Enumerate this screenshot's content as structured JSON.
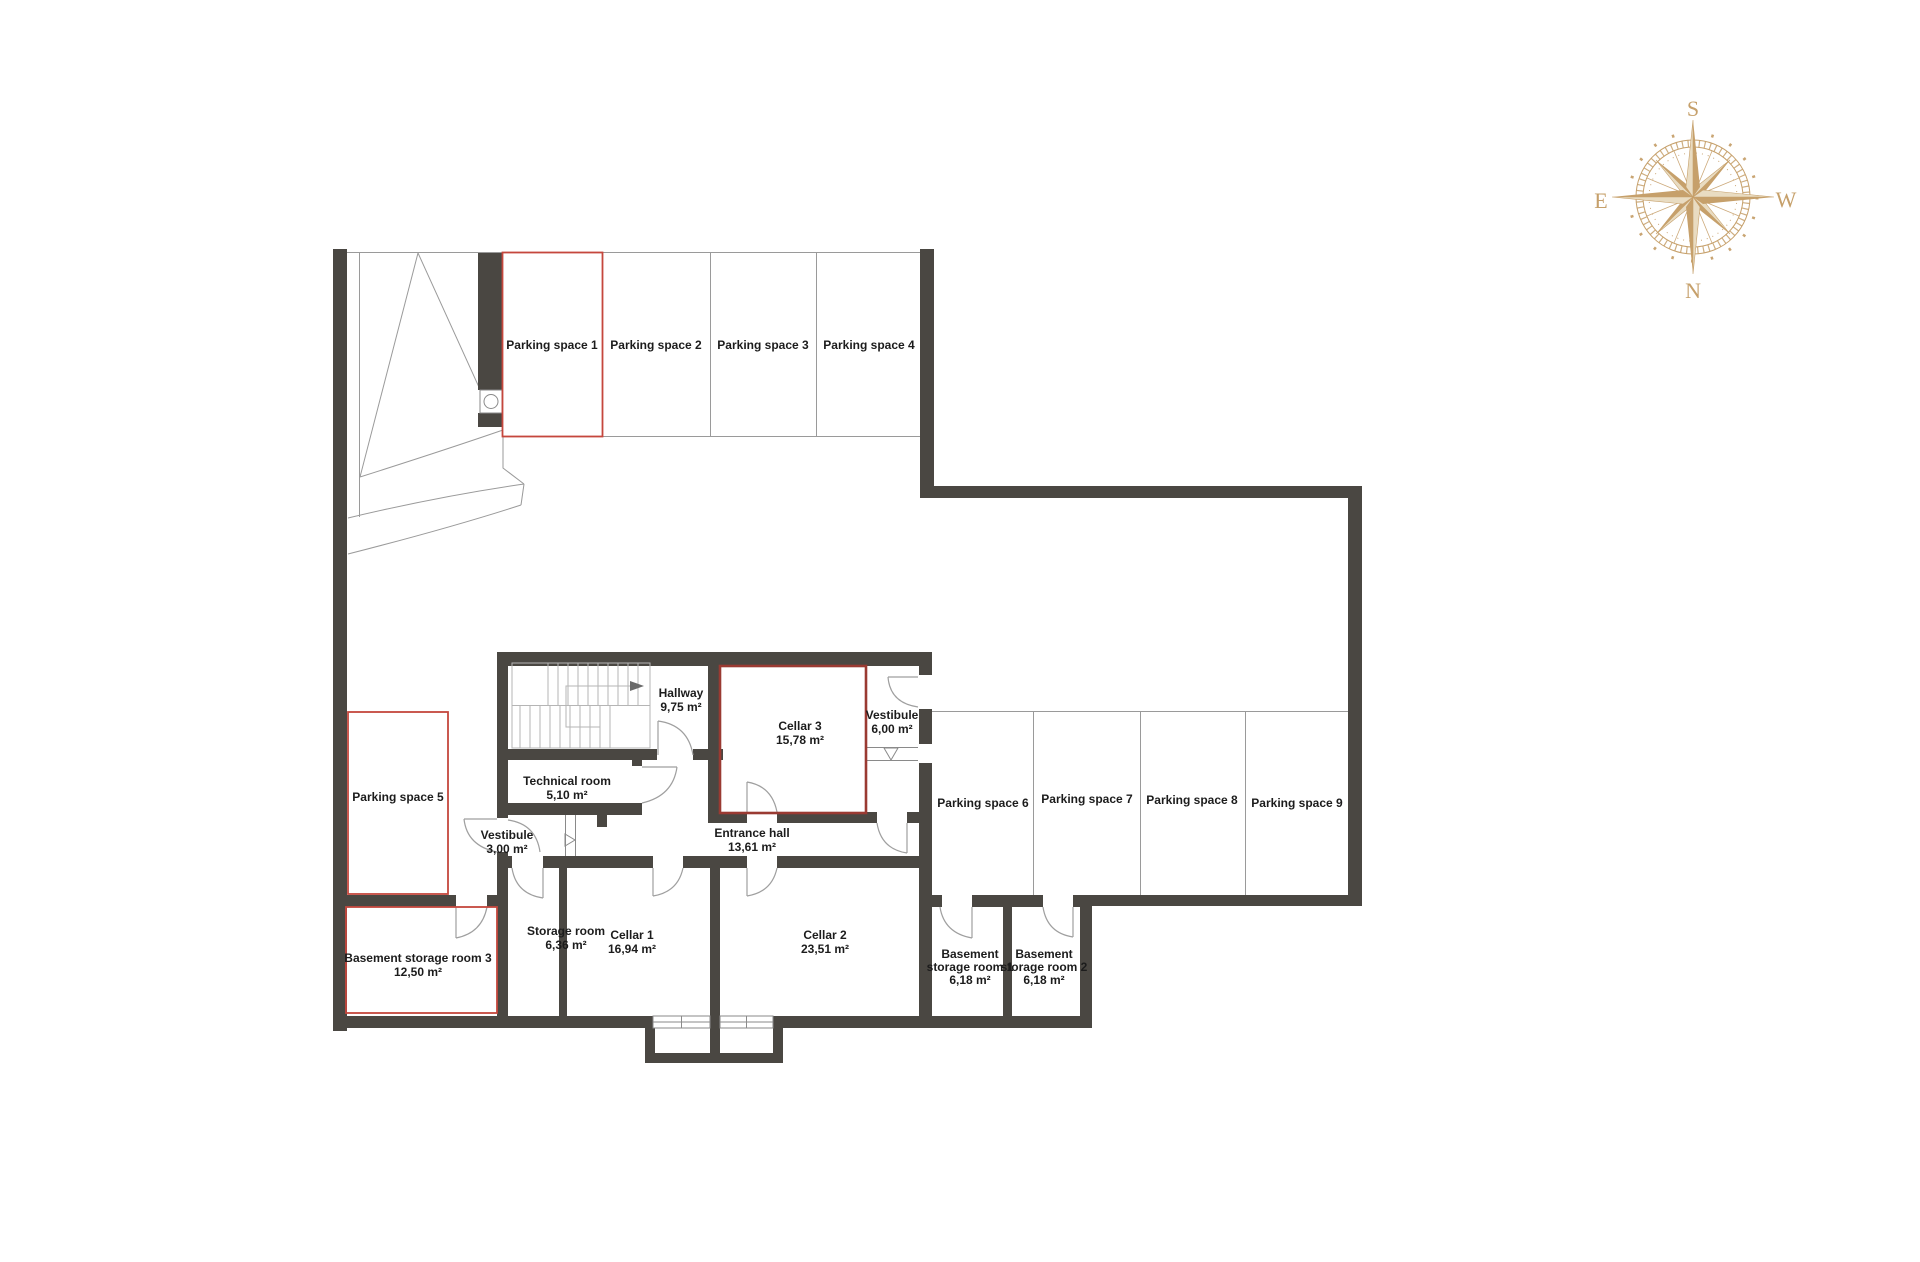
{
  "colors": {
    "wall": "#4a4742",
    "red_accent": "#c5473d",
    "red_dark": "#9a3a32",
    "compass_gold": "#c6a06b",
    "line": "#9a9a9a",
    "text": "#1c1c1c"
  },
  "compass": {
    "south": "S",
    "west": "W",
    "north": "N",
    "east": "E"
  },
  "rooms": {
    "parking1": {
      "label": "Parking space 1"
    },
    "parking2": {
      "label": "Parking space 2"
    },
    "parking3": {
      "label": "Parking space 3"
    },
    "parking4": {
      "label": "Parking space 4"
    },
    "parking5": {
      "label": "Parking space 5"
    },
    "parking6": {
      "label": "Parking space 6"
    },
    "parking7": {
      "label": "Parking space 7"
    },
    "parking8": {
      "label": "Parking space 8"
    },
    "parking9": {
      "label": "Parking space 9"
    },
    "hallway": {
      "name": "Hallway",
      "area": "9,75 m²"
    },
    "cellar3": {
      "name": "Cellar 3",
      "area": "15,78 m²"
    },
    "vestibule6": {
      "name": "Vestibule",
      "area": "6,00 m²"
    },
    "technical": {
      "name": "Technical room",
      "area": "5,10 m²"
    },
    "vestibule3": {
      "name": "Vestibule",
      "area": "3,00 m²"
    },
    "entrance": {
      "name": "Entrance hall",
      "area": "13,61 m²"
    },
    "storage": {
      "name": "Storage room",
      "area": "6,36 m²"
    },
    "cellar1": {
      "name": "Cellar 1",
      "area": "16,94 m²"
    },
    "cellar2": {
      "name": "Cellar 2",
      "area": "23,51 m²"
    },
    "bstorage1": {
      "line1": "Basement",
      "line2": "storage room 1",
      "area": "6,18 m²"
    },
    "bstorage2": {
      "line1": "Basement",
      "line2": "storage room 2",
      "area": "6,18 m²"
    },
    "bstorage3": {
      "name": "Basement storage room 3",
      "area": "12,50 m²"
    }
  }
}
